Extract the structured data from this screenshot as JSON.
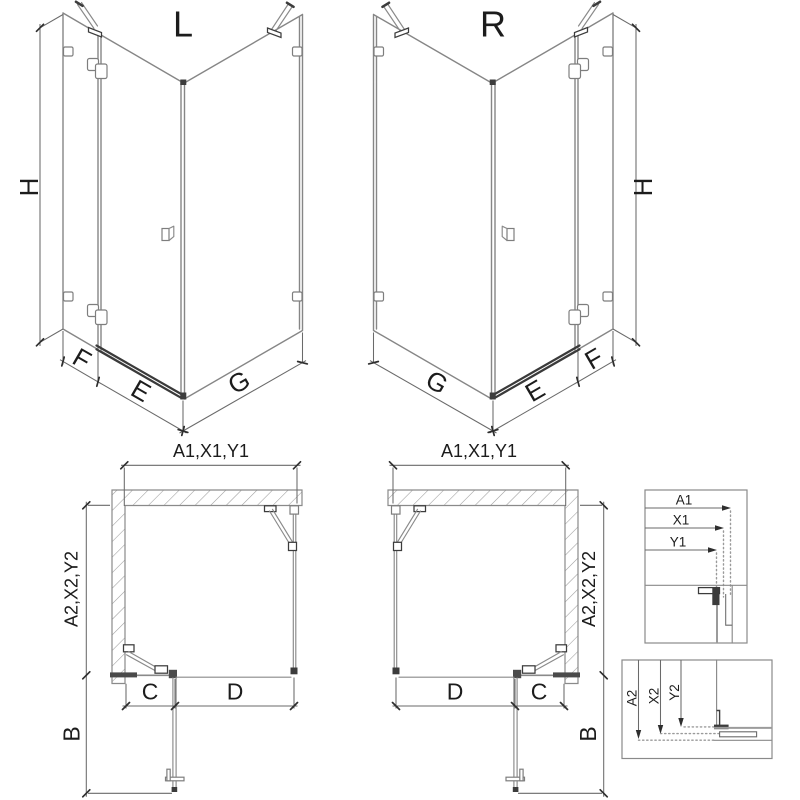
{
  "diagram": {
    "iso_left": {
      "variant_label": "L",
      "height_label": "H",
      "fixed_panel_label": "F",
      "door_label": "E",
      "side_panel_label": "G"
    },
    "iso_right": {
      "variant_label": "R",
      "height_label": "H",
      "fixed_panel_label": "F",
      "door_label": "E",
      "side_panel_label": "G"
    },
    "plan_left": {
      "width_label": "A1,X1,Y1",
      "depth_label": "A2,X2,Y2",
      "fixed_segment_label": "C",
      "door_opening_label": "D",
      "door_swing_label": "B"
    },
    "plan_right": {
      "width_label": "A1,X1,Y1",
      "depth_label": "A2,X2,Y2",
      "fixed_segment_label": "C",
      "door_opening_label": "D",
      "door_swing_label": "B"
    },
    "detail_width": {
      "labels": [
        "A1",
        "X1",
        "Y1"
      ]
    },
    "detail_depth": {
      "labels": [
        "A2",
        "X2",
        "Y2"
      ]
    },
    "colors": {
      "structure_line": "#868686",
      "dimension_line": "#6a6a6a",
      "dark_detail": "#3c3c3c",
      "hatch": "#9b9b9b",
      "text": "#1c1c1c",
      "background": "#ffffff"
    }
  }
}
